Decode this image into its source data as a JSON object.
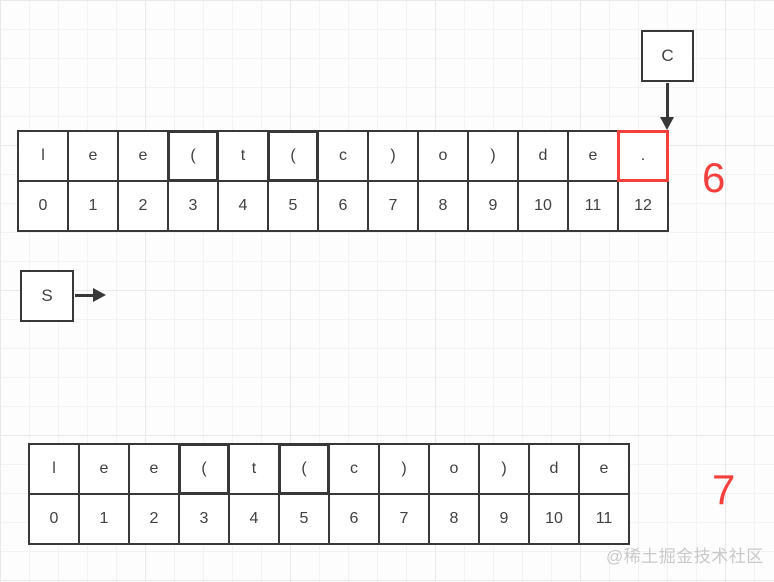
{
  "canvas": {
    "width": 774,
    "height": 582
  },
  "colors": {
    "background": "#fdfdfd",
    "grid_minor": "#f3f3f3",
    "grid_major": "#e9e9e9",
    "stroke": "#383838",
    "cell_text": "#404040",
    "red": "#f4403d",
    "watermark_text": "#c9c9c9"
  },
  "pointers": {
    "c_box": {
      "label": "C"
    },
    "s_box": {
      "label": "S"
    }
  },
  "annotations": {
    "top_count": "6",
    "bottom_count": "7"
  },
  "watermark": {
    "text": "@稀土掘金技术社区"
  },
  "arrays": [
    {
      "id": "top",
      "string": "lee(t(c)o)de.",
      "chars": [
        "l",
        "e",
        "e",
        "(",
        "t",
        "(",
        "c",
        ")",
        "o",
        ")",
        "d",
        "e",
        "."
      ],
      "indices": [
        "0",
        "1",
        "2",
        "3",
        "4",
        "5",
        "6",
        "7",
        "8",
        "9",
        "10",
        "11",
        "12"
      ],
      "bold_char_cells": [
        3,
        5
      ],
      "red_char_cells": [
        12
      ]
    },
    {
      "id": "bottom",
      "string": "lee(t(c)o)de",
      "chars": [
        "l",
        "e",
        "e",
        "(",
        "t",
        "(",
        "c",
        ")",
        "o",
        ")",
        "d",
        "e"
      ],
      "indices": [
        "0",
        "1",
        "2",
        "3",
        "4",
        "5",
        "6",
        "7",
        "8",
        "9",
        "10",
        "11"
      ],
      "bold_char_cells": [
        3,
        5
      ],
      "red_char_cells": []
    }
  ]
}
